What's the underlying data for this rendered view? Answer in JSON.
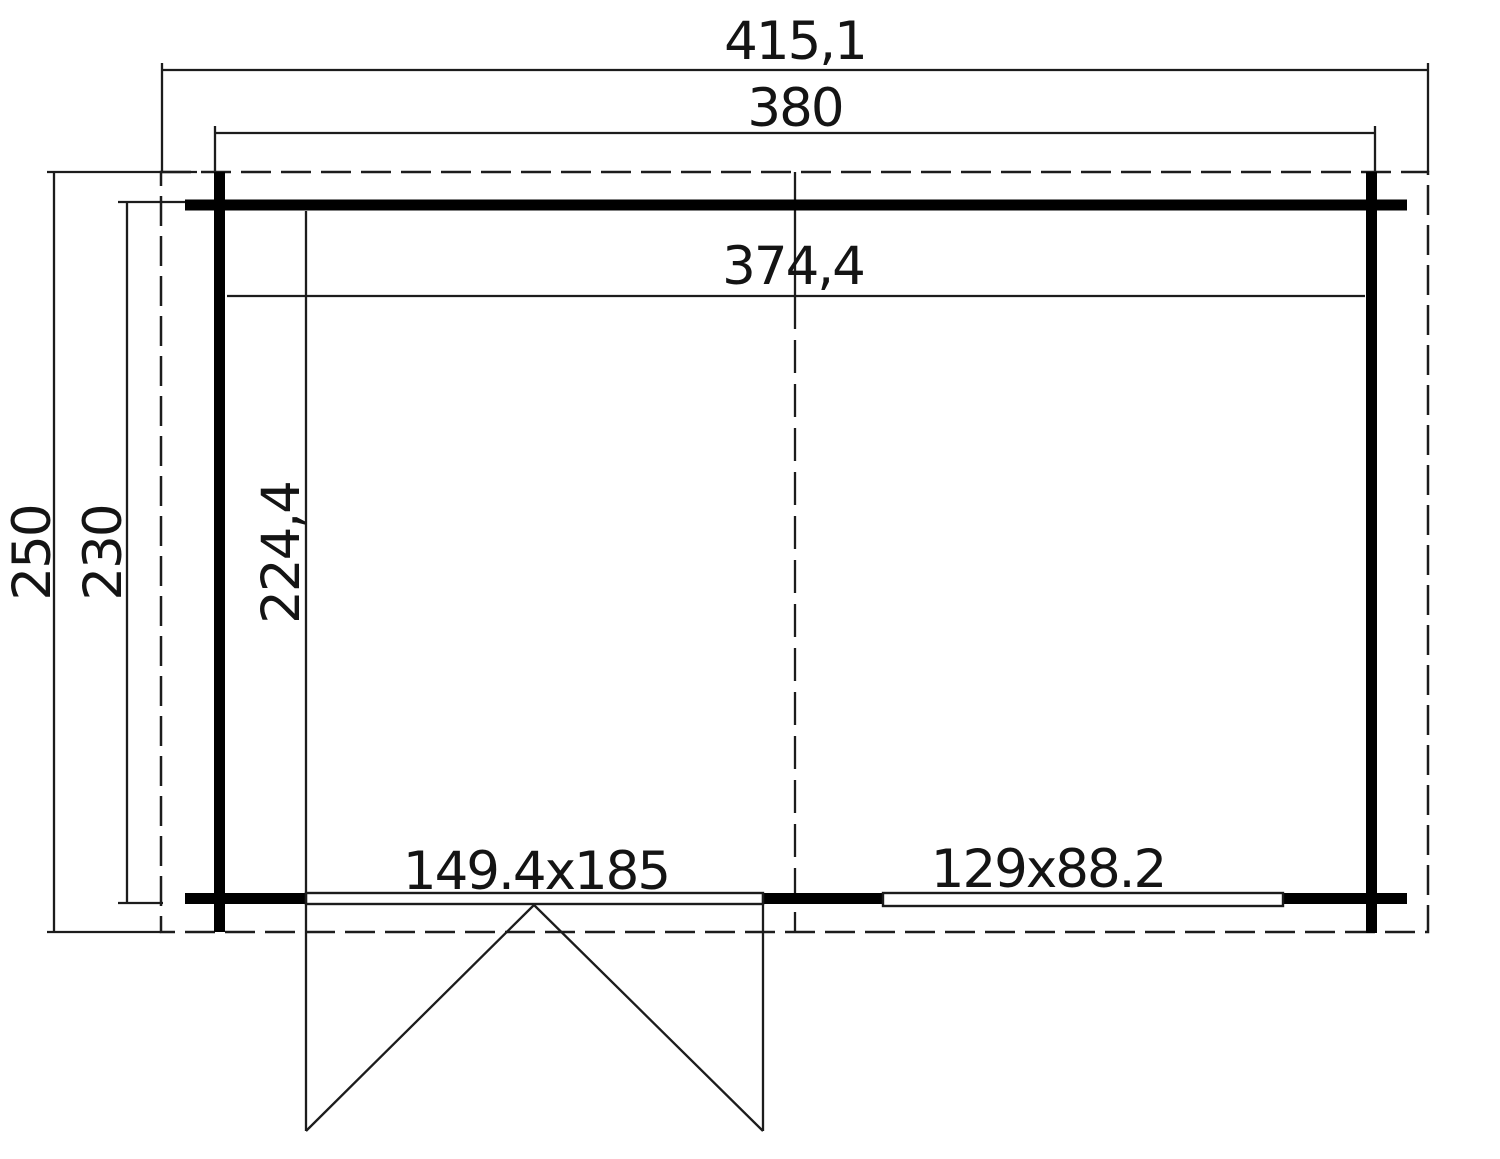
{
  "drawing": {
    "type": "architectural floor plan",
    "dimensions": {
      "roof_width": "415,1",
      "outer_width": "380",
      "inner_width": "374,4",
      "roof_depth": "250",
      "outer_depth": "230",
      "inner_depth": "224,4"
    },
    "openings": {
      "door_size": "149.4x185",
      "window_size": "129x88.2"
    },
    "style": {
      "line_color": "#1c1c1c",
      "wall_color": "#000000",
      "background": "#ffffff"
    }
  }
}
